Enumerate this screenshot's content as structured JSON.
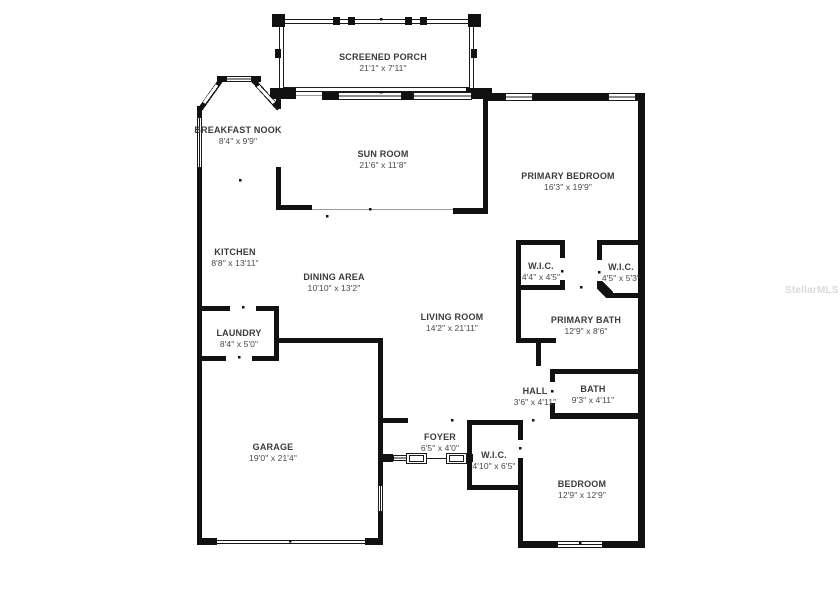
{
  "watermark": "StellarMLS",
  "rooms": {
    "screened_porch": {
      "name": "SCREENED PORCH",
      "dims": "21'1\" x 7'11\""
    },
    "breakfast_nook": {
      "name": "BREAKFAST NOOK",
      "dims": "8'4\" x 9'9\""
    },
    "sun_room": {
      "name": "SUN ROOM",
      "dims": "21'6\" x 11'8\""
    },
    "primary_bedroom": {
      "name": "PRIMARY BEDROOM",
      "dims": "16'3\" x 19'9\""
    },
    "kitchen": {
      "name": "KITCHEN",
      "dims": "8'8\" x 13'11\""
    },
    "dining_area": {
      "name": "DINING AREA",
      "dims": "10'10\" x 13'2\""
    },
    "living_room": {
      "name": "LIVING ROOM",
      "dims": "14'2\" x 21'11\""
    },
    "wic_primary_1": {
      "name": "W.I.C.",
      "dims": "4'4\" x 4'5\""
    },
    "wic_primary_2": {
      "name": "W.I.C.",
      "dims": "4'5\" x 5'3\""
    },
    "primary_bath": {
      "name": "PRIMARY BATH",
      "dims": "12'9\" x 8'6\""
    },
    "laundry": {
      "name": "LAUNDRY",
      "dims": "8'4\" x 5'0\""
    },
    "hall": {
      "name": "HALL",
      "dims": "3'6\" x 4'11\""
    },
    "bath": {
      "name": "BATH",
      "dims": "9'3\" x 4'11\""
    },
    "garage": {
      "name": "GARAGE",
      "dims": "19'0\" x 21'4\""
    },
    "foyer": {
      "name": "FOYER",
      "dims": "6'5\" x 4'0\""
    },
    "wic_bedroom": {
      "name": "W.I.C.",
      "dims": "4'10\" x 6'5\""
    },
    "bedroom": {
      "name": "BEDROOM",
      "dims": "12'9\" x 12'9\""
    }
  }
}
